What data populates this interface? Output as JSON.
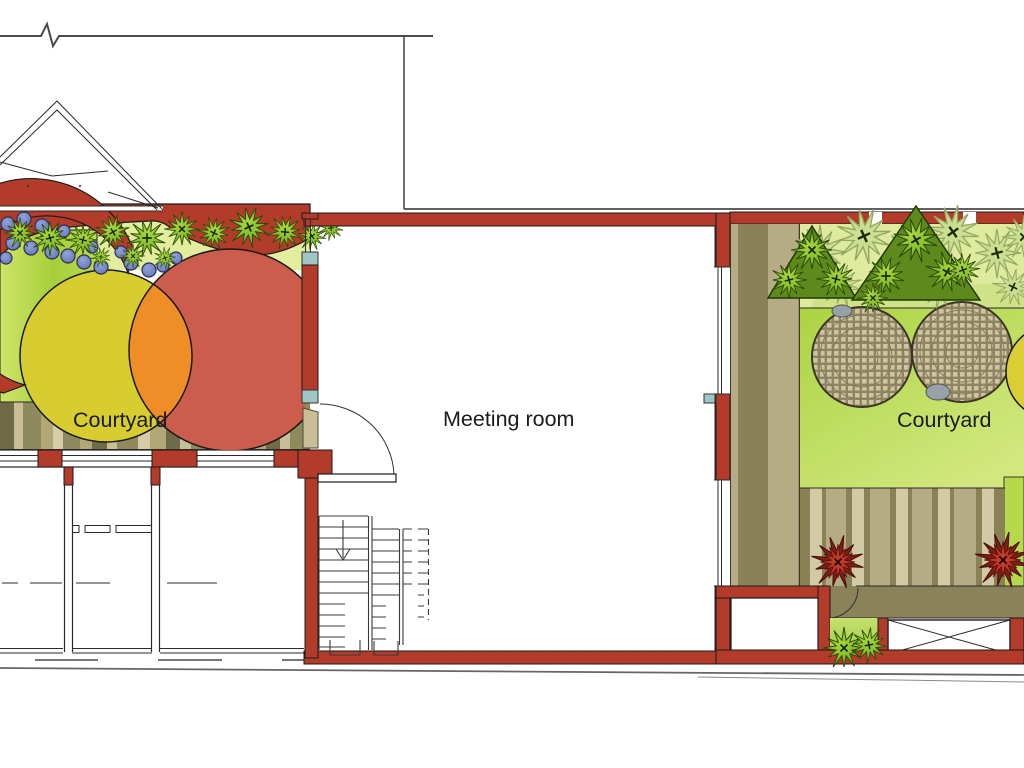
{
  "page": {
    "title": "Architectural site plan with two courtyards and a meeting room"
  },
  "labels": {
    "left_courtyard": "Courtyard",
    "meeting_room": "Meeting room",
    "right_courtyard": "Courtyard"
  },
  "palette": {
    "wall-red": "#B23B2A",
    "circle-red": "#CC5C4B",
    "circle-yellow": "#D8CD30",
    "circle-orange": "#EF8E26",
    "lawn-green": "#A9D13F",
    "pale-green-strip": "#DEEA9E",
    "shrub-green": "#7CB82E",
    "shrub-pale": "#CCDF90",
    "berry-blue": "#7283C6",
    "paving-tan": "#B2A877",
    "paving-olive": "#8A8156",
    "mosaic-tan": "#CDC4A0",
    "walkway-olive": "#8A8258",
    "plant-red": "#C23B28",
    "window-teal": "#9FC5C7",
    "line-dark": "#1A1A1A"
  }
}
